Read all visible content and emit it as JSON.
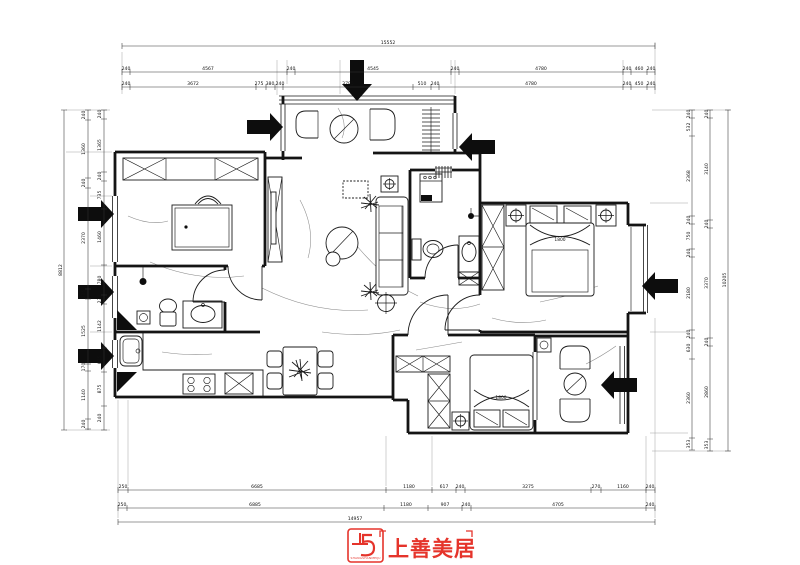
{
  "document": {
    "type": "residential floor plan drawing"
  },
  "dims": {
    "top_total": "15552",
    "top1": [
      "240",
      "4567",
      "240",
      "4545",
      "240",
      "4780",
      "240",
      "460",
      "240"
    ],
    "top2": [
      "240",
      "3672",
      "275",
      "380",
      "240",
      "3795",
      "510",
      "240",
      "4780",
      "240",
      "450",
      "240"
    ],
    "left_total": "8812",
    "left1": [
      "240",
      "1360",
      "240",
      "2370",
      "235",
      "1525",
      "170",
      "1140",
      "240"
    ],
    "left2": [
      "240",
      "1365",
      "240",
      "735",
      "1460",
      "780",
      "230",
      "1142",
      "635",
      "875",
      "240"
    ],
    "right_total": "10205",
    "right1": [
      "240",
      "532",
      "2368",
      "240",
      "750",
      "240",
      "2180",
      "240",
      "630",
      "2360",
      "353"
    ],
    "right2": [
      "240",
      "3140",
      "240",
      "3370",
      "240",
      "2860",
      "353"
    ],
    "bottom_total": "14957",
    "bottom1": [
      "250",
      "6685",
      "1180",
      "617",
      "240",
      "3275",
      "270",
      "1160",
      "240"
    ],
    "bottom2": [
      "250",
      "6885",
      "1180",
      "907",
      "240",
      "4705",
      "240"
    ]
  },
  "labels": {
    "master_bed": "1800",
    "second_bed": "1800"
  },
  "icons": {
    "arrows": [
      "down-arrow",
      "right-arrow",
      "right-arrow",
      "right-arrow",
      "right-arrow",
      "left-arrow",
      "left-arrow",
      "left-arrow"
    ],
    "colors": {
      "line": "#141414",
      "accent_red": "#e5342b"
    }
  },
  "logo": {
    "brand": "上善美居",
    "subtext": "SHANGSHANMEIJU"
  }
}
